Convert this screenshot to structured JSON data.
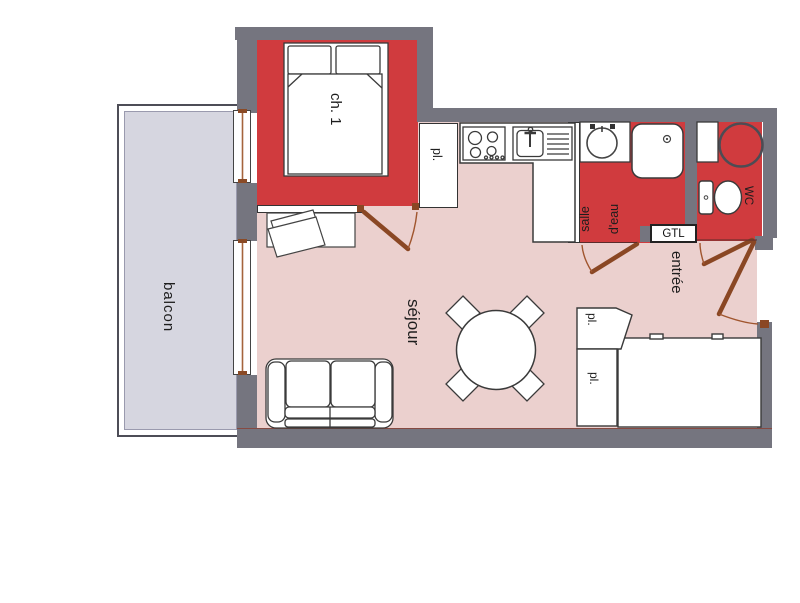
{
  "labels": {
    "balcony": "balcon",
    "bedroom": "ch. 1",
    "living_room": "séjour",
    "entry": "entrée",
    "bathroom_line1": "salle",
    "bathroom_line2": "d'eau",
    "wc": "WC",
    "closet": "pl.",
    "technical_duct": "GTL"
  },
  "colors": {
    "room_red": "#d03b3e",
    "floor_pink": "#ebd0ce",
    "balcony_gray": "#d6d6e0",
    "wall_gray": "#75757f",
    "door_brown": "#8a4724",
    "outline": "#3a3a3a"
  }
}
